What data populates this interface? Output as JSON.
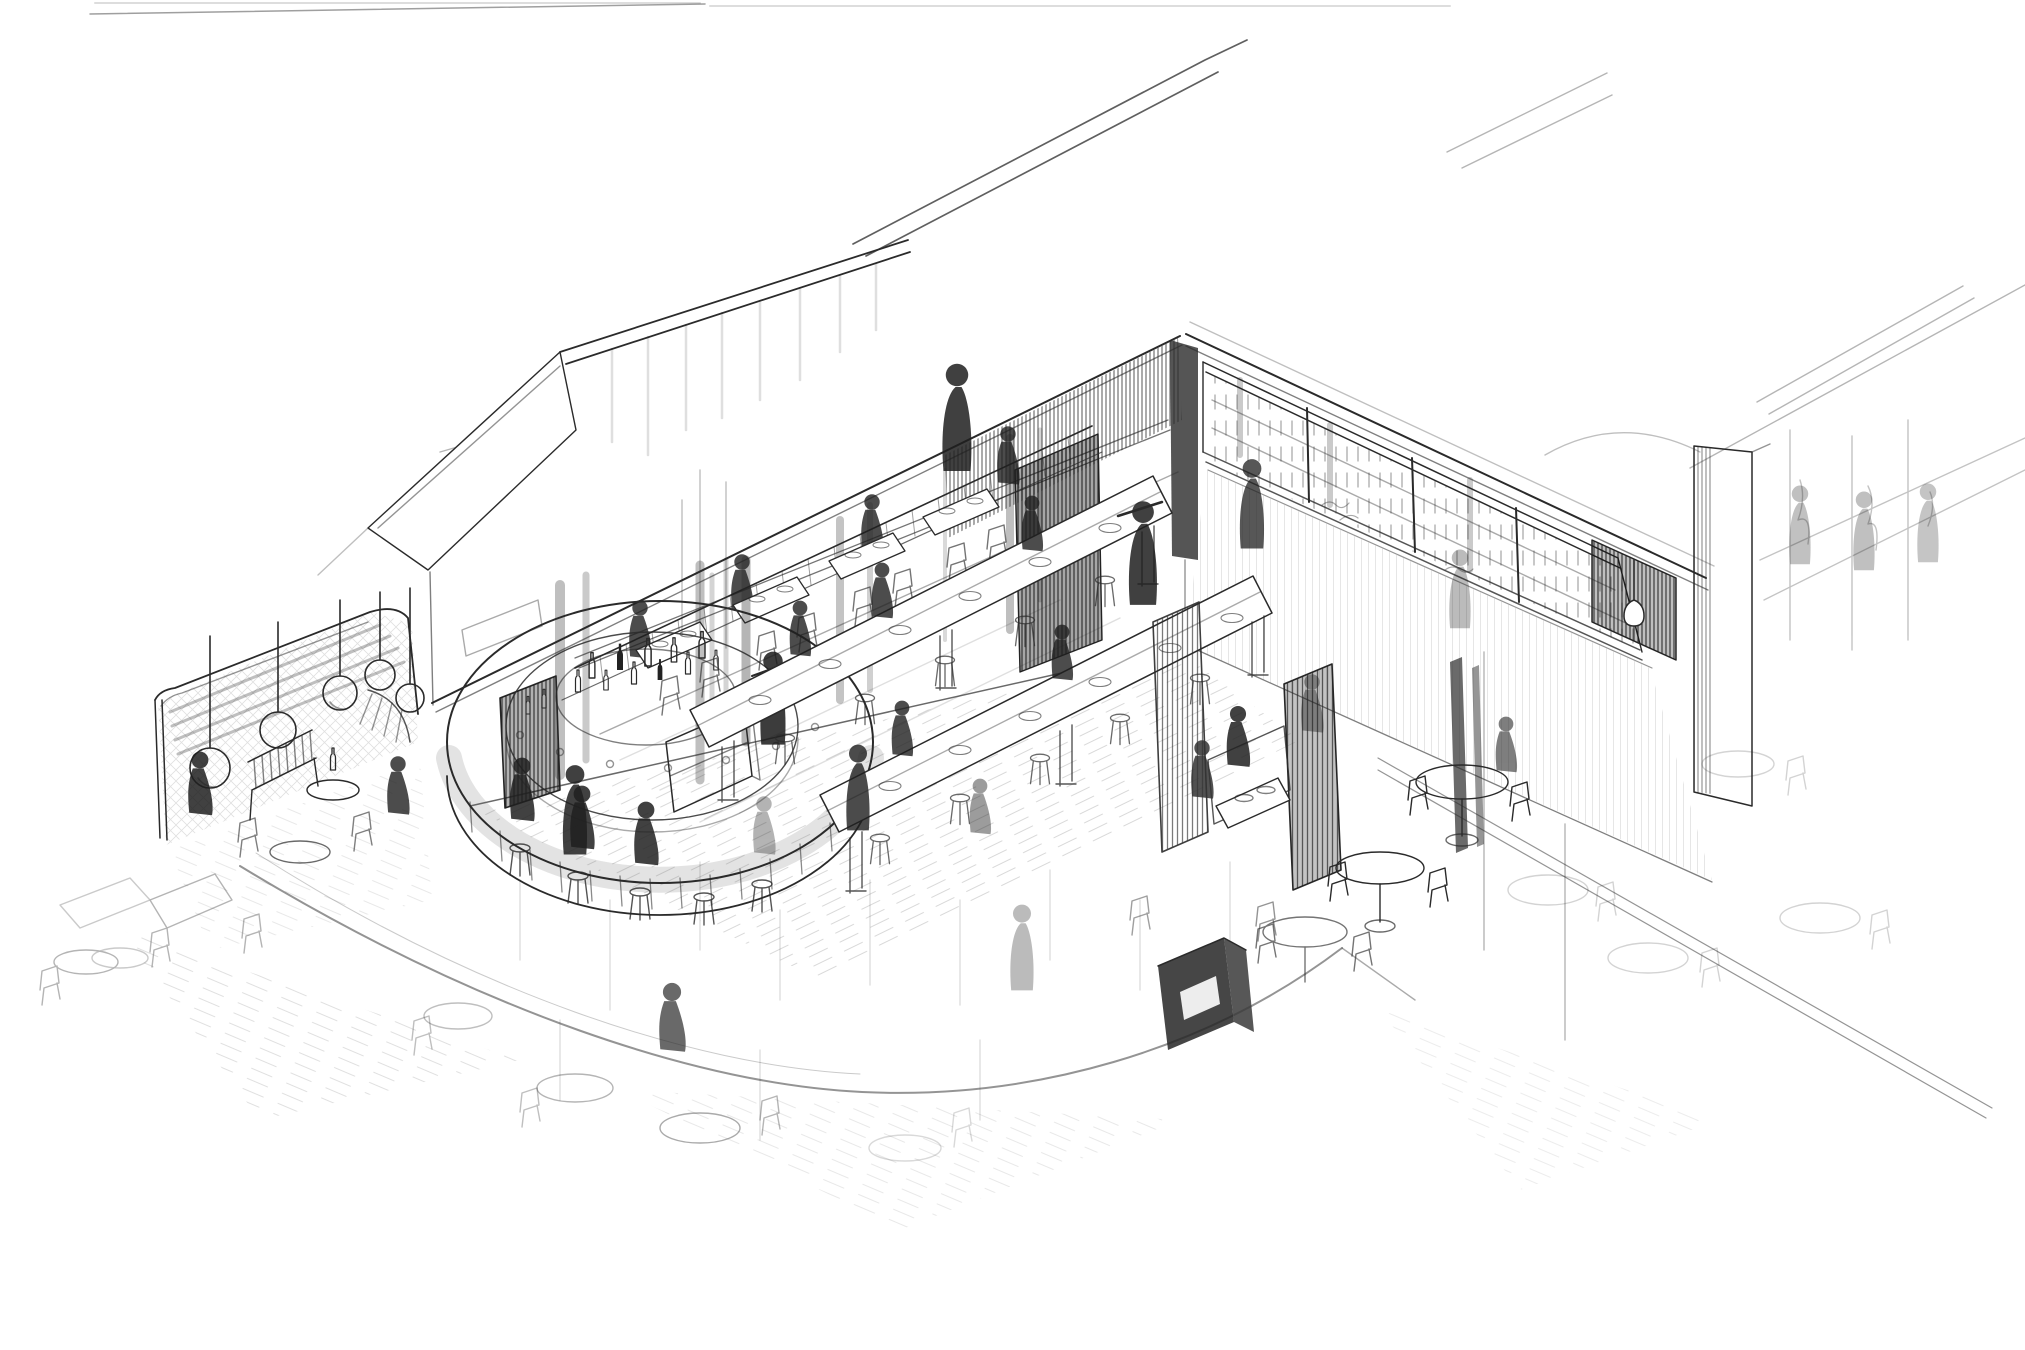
{
  "artwork": {
    "title": "Restaurant interior perspective sketch",
    "medium": "monochrome pencil and ink line drawing on white paper",
    "style": "loose architectural concept sketch, aerial cutaway two-point perspective",
    "palette": {
      "paper": "#ffffff",
      "ink_dark": "#1f1f1f",
      "ink_mid": "#2a2a2a",
      "ink_soft": "#555555",
      "ink_faint": "#9a9a9a"
    }
  },
  "scene": {
    "setting": "large restaurant and bar hall with a round central bar, drawn fading out toward the foreground",
    "elements": [
      {
        "name": "rooflines",
        "description": "long parallel building roof-edge lines running toward the upper right"
      },
      {
        "name": "lounge-alcove",
        "description": "curved-corner lounge nook with cross-hatched walls at the left"
      },
      {
        "name": "pendant-lights",
        "description": "globe pendant lamps hanging on cords in the alcove",
        "count": 5
      },
      {
        "name": "slatted-bench",
        "description": "wooden bench with slatted back and small tables in the alcove"
      },
      {
        "name": "gable-wall",
        "description": "white gable wall plane with a dark door opening"
      },
      {
        "name": "back-wall",
        "description": "vertically hatched back wall with picture rails and a dark corner doorway"
      },
      {
        "name": "clerestory-wine-wall",
        "description": "high window band with mullions and bottle shelves on the right wall"
      },
      {
        "name": "wall-niche",
        "description": "dark recessed niche with a small pendant lamp in the right wall"
      },
      {
        "name": "circular-bar",
        "description": "round bar counter with hatched front, central bottle island and bartender"
      },
      {
        "name": "bottles",
        "description": "liquor bottles clustered on the bar island and shelves"
      },
      {
        "name": "bar-stools",
        "description": "stools with seated guests around the bar front"
      },
      {
        "name": "banquette-row",
        "description": "bench seating with small tables and chairs along the back wall"
      },
      {
        "name": "communal-tables",
        "description": "long shared tables with stools, plates and seated figures",
        "count": 2
      },
      {
        "name": "booths",
        "description": "high-back booth seating with dark wood partition panels"
      },
      {
        "name": "host-podium",
        "description": "dark service podium with open shelf near the booths"
      },
      {
        "name": "round-tables",
        "description": "round two-top pedestal tables with chairs along the front right"
      },
      {
        "name": "cafe-tables",
        "description": "loose foreground cafe tables and chairs fading toward the sheet edge"
      },
      {
        "name": "guests-and-staff",
        "description": "sketched silhouette figures, standing servers and seated diners"
      },
      {
        "name": "floor-hatching",
        "description": "sparse diagonal floor strokes with a long curved floor seam"
      },
      {
        "name": "adjacent-space",
        "description": "faintly sketched neighboring space beyond the right pier and glazing"
      }
    ]
  }
}
